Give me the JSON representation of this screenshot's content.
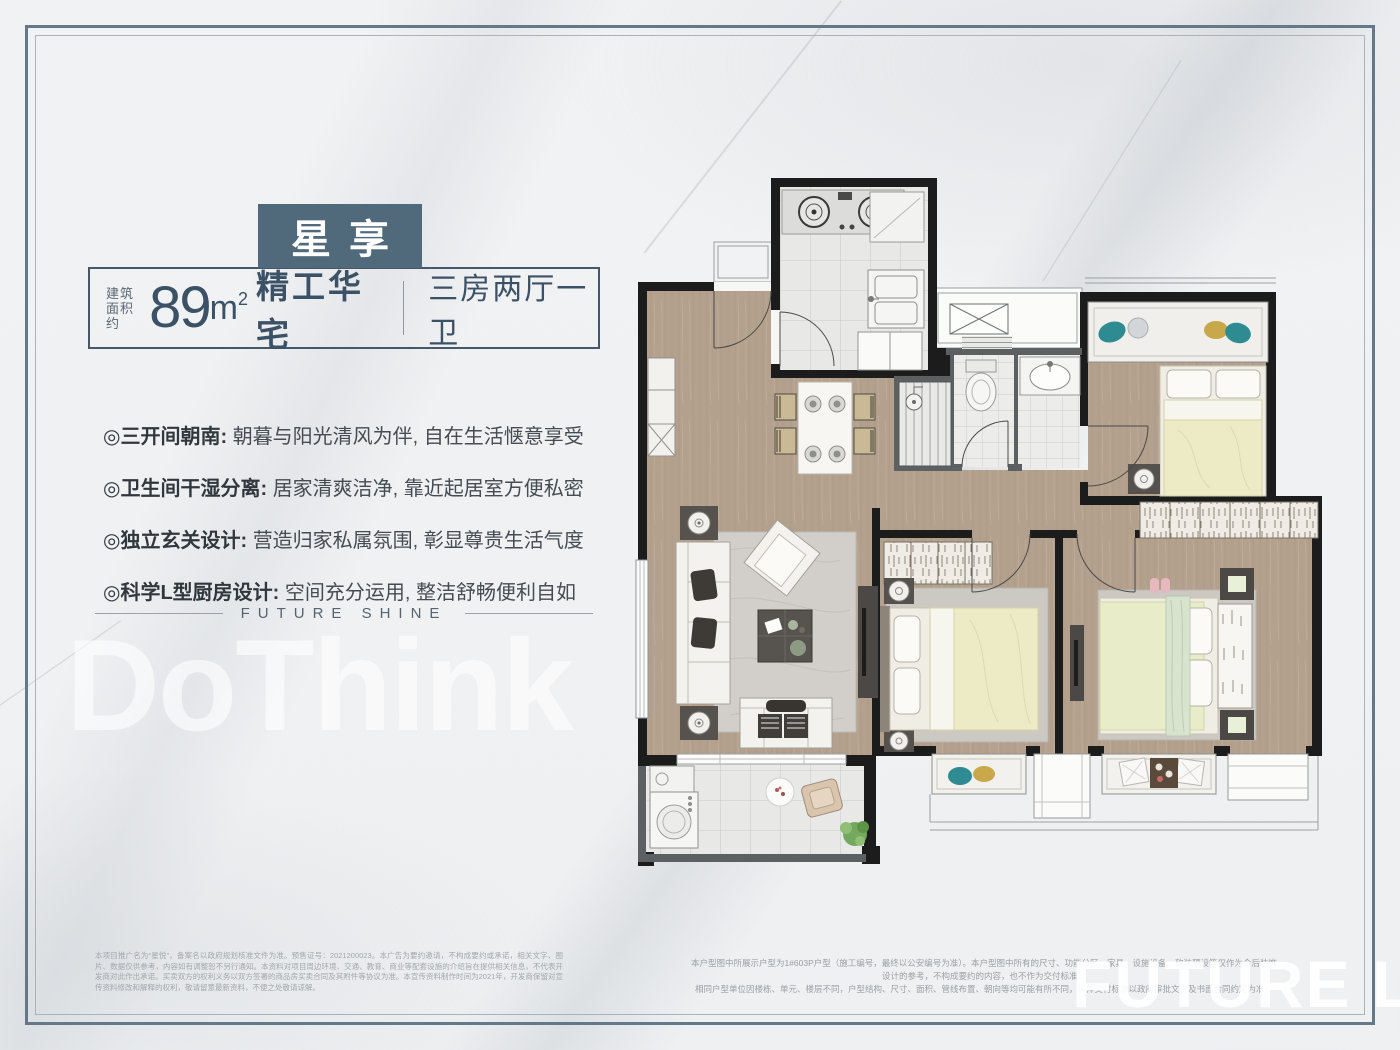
{
  "colors": {
    "accent": "#50697b",
    "text_dark": "#3b5165",
    "frame_outer": "#64788a",
    "frame_inner": "#a9b3bb"
  },
  "header": {
    "title": "星享",
    "area_prefix_line1": "建筑",
    "area_prefix_line2": "面积约",
    "area_value": "89",
    "area_unit": "m",
    "area_sup": "2",
    "area_suffix": "精工华宅",
    "layout": "三房两厅一卫"
  },
  "selling_points": [
    {
      "label": "◎三开间朝南:",
      "desc": "朝暮与阳光清风为伴, 自在生活惬意享受"
    },
    {
      "label": "◎卫生间干湿分离:",
      "desc": "居家清爽洁净, 靠近起居室方便私密"
    },
    {
      "label": "◎独立玄关设计:",
      "desc": "营造归家私属氛围, 彰显尊贵生活气度"
    },
    {
      "label": "◎科学L型厨房设计:",
      "desc": "空间充分运用, 整洁舒畅便利自如"
    }
  ],
  "divider": {
    "text": "FUTURE SHINE"
  },
  "watermarks": {
    "left": "DoThink",
    "bottom_right": "FUTURE LIFE"
  },
  "disclaimers": {
    "left": "本项目推广名为“星悦”，备案名以政府规划核准文件为准。预售证号：2021200023。本广告为要约邀请，不构成要约或承诺，相关文字、图片、数据仅供参考，内容如有调整恕不另行通知。本资料对项目周边环境、交通、教育、商业等配套设施的介绍旨在提供相关信息，不代表开发商对此作出承诺。买卖双方的权利义务以双方签署的商品房买卖合同及其附件等协议为准。本宣传资料制作时间为2021年，开发商保留对宣传资料修改和解释的权利，敬请留意最新资料，不便之处敬请谅解。",
    "right_line1": "本户型图中所展示户型为1#603P户型（施工编号，最终以公安编号为准）。本户型图中所有的尺寸、功能分区、家具、设施设备、软装预设等仅作为今后装饰设计的参考，不构成要约的内容，也不作为交付标准。",
    "right_line2": "相同户型单位因楼栋、单元、楼层不同，户型结构、尺寸、面积、管线布置、朝向等均可能有所不同，具体交付标准以政府审批文件及书面合同约定为准。"
  }
}
